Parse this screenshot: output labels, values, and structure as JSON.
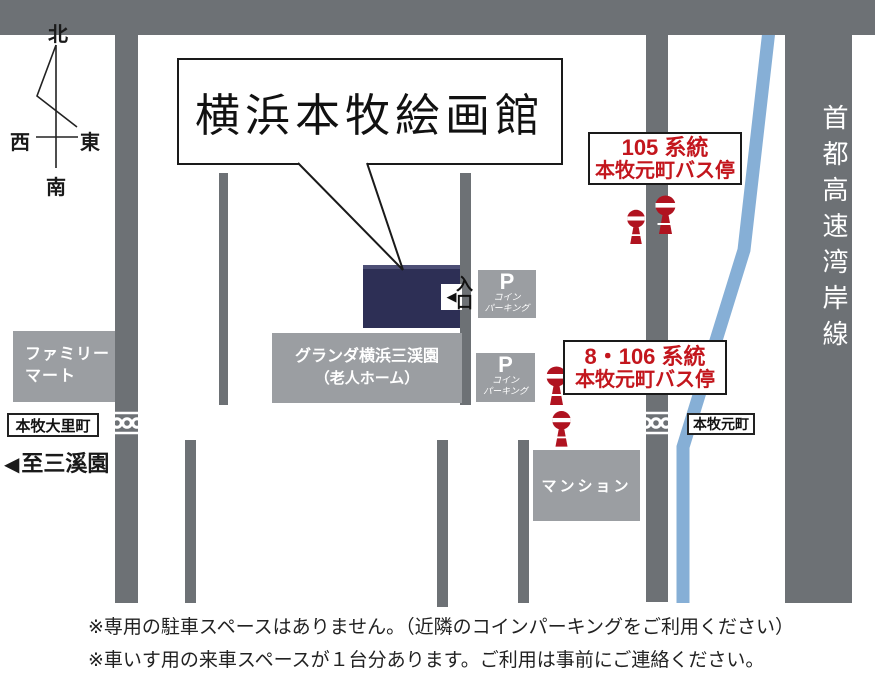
{
  "title": "横浜本牧絵画館",
  "compass": {
    "north": "北",
    "south": "南",
    "west": "西",
    "east": "東"
  },
  "roads": {
    "hachioji_label": "八王子道路",
    "highway_label": "首都高速湾岸線",
    "intersection_west": "本牧大里町",
    "intersection_east": "本牧元町",
    "sankeien_arrow": "◀",
    "sankeien_label": "至三溪園"
  },
  "bus_stops": {
    "route105": {
      "line1": "105 系統",
      "line2": "本牧元町バス停"
    },
    "route8_106": {
      "line1": "8・106 系統",
      "line2": "本牧元町バス停"
    }
  },
  "buildings": {
    "familymart": {
      "line1": "ファミリー",
      "line2": "マート"
    },
    "granda": {
      "line1": "グランダ横浜三渓園",
      "line2": "（老人ホーム）"
    },
    "mansion": "マンション",
    "parking": {
      "p": "P",
      "line1": "コイン",
      "line2": "パーキング"
    },
    "entrance_arrow": "◀",
    "entrance_label": "入口"
  },
  "notes": {
    "line1": "※専用の駐車スペースはありません。（近隣のコインパーキングをご利用ください）",
    "line2": "※車いす用の来車スペースが１台分あります。ご利用は事前にご連絡ください。"
  },
  "colors": {
    "road_gray": "#6d7175",
    "building_gray": "#9b9ea2",
    "museum_navy": "#2d2f55",
    "route_blue": "#86afd6",
    "label_red": "#c3161d",
    "bus_icon_red": "#b01320"
  }
}
